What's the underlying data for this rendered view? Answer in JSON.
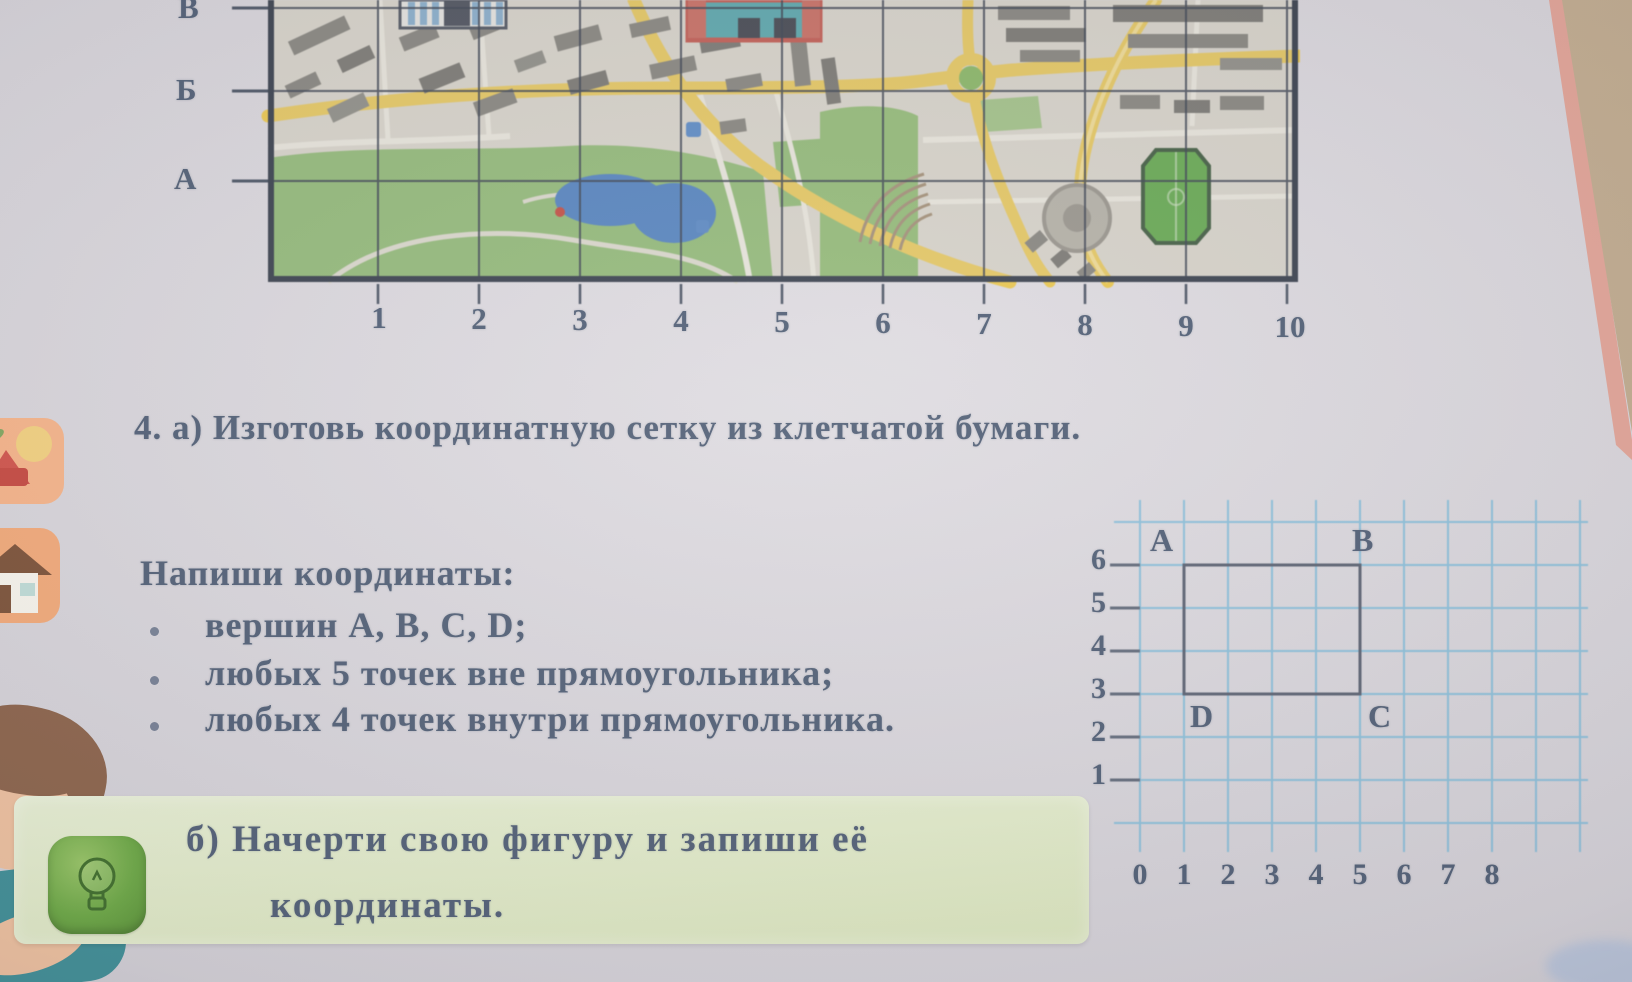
{
  "figure_map": {
    "row_labels": [
      "В",
      "Б",
      "А"
    ],
    "column_labels": [
      "1",
      "2",
      "3",
      "4",
      "5",
      "6",
      "7",
      "8",
      "9",
      "10"
    ]
  },
  "exercise": {
    "part_a": "4. а) Изготовь координатную сетку из клетчатой бумаги.",
    "heading": "Напиши координаты:",
    "bullets": [
      "вершин A, B, C, D;",
      "любых 5 точек вне прямоугольника;",
      "любых 4 точек внутри прямоугольника."
    ],
    "part_b_line1": "б) Начерти свою фигуру и запиши её",
    "part_b_line2": "координаты."
  },
  "figure_grid": {
    "y_labels": [
      "6",
      "5",
      "4",
      "3",
      "2",
      "1"
    ],
    "x_labels": [
      "0",
      "1",
      "2",
      "3",
      "4",
      "5",
      "6",
      "7",
      "8"
    ],
    "vertices": {
      "top_left": "A",
      "top_right": "B",
      "bottom_right": "C",
      "bottom_left": "D"
    },
    "rectangle_units": {
      "x_range": [
        1,
        5
      ],
      "y_range": [
        3,
        6
      ]
    }
  },
  "colors": {
    "page_text": "#4f5d74",
    "highlight_box_green": "#dde8c3",
    "grid_blue": "#86bdd8",
    "road_yellow": "#e9c64f",
    "park_green": "#88b669",
    "pond_blue": "#4176ba",
    "stadium_green": "#55a23c"
  }
}
